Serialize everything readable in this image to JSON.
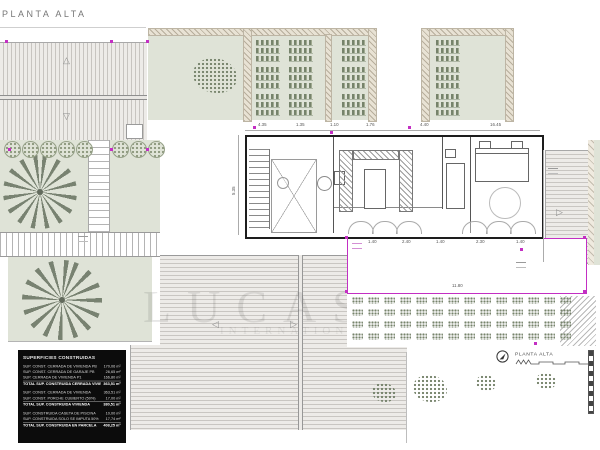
{
  "title": "PLANTA ALTA",
  "legend": {
    "label": "PLANTA ALTA"
  },
  "watermark": {
    "line1": "LUCAS F",
    "line2": "INTERNATIONAL PROPERTIES"
  },
  "colors": {
    "accent_magenta": "#c32fc3",
    "garden_green": "#dfe3d7",
    "plant_green": "#76836b",
    "wall_black": "#1d1d1d",
    "table_bg": "#0c0c0c",
    "deck_line": "#c9c6c2"
  },
  "areas_table": {
    "header": "SUPERFICIES CONSTRUIDAS",
    "groups": [
      {
        "rows": [
          {
            "label": "SUP. CONST. CERRADA DE VIVIENDA PB",
            "value": "170,06 m²",
            "total": false
          },
          {
            "label": "SUP. CONST. CERRADA DE GARAJE PB",
            "value": "26,65 m²",
            "total": false
          },
          {
            "label": "SUP. CERRADA DE VIVIENDA P1",
            "value": "166,80 m²",
            "total": false
          },
          {
            "label": "TOTAL SUP. CONSTRUIDA CERRADA VIVIENDA",
            "value": "363,51 m²",
            "total": true
          }
        ]
      },
      {
        "rows": [
          {
            "label": "SUP. CONST. CERRADA DE VIVIENDA",
            "value": "363,51 m²",
            "total": false
          },
          {
            "label": "SUP. CONST. PORCHE CUBIERTO (50%)",
            "value": "17,00 m²",
            "total": false
          },
          {
            "label": "TOTAL SUP. CONSTRUIDA VIVIENDA",
            "value": "380,51 m²",
            "total": true
          }
        ]
      },
      {
        "rows": [
          {
            "label": "SUP. CONSTRUIDA CASETA DE PISCINA",
            "value": "10,00 m²",
            "total": false
          },
          {
            "label": "SUP. CONSTRUIDA SOLO SE IMPUTA 50%",
            "value": "17,74 m²",
            "total": false
          },
          {
            "label": "TOTAL SUP. CONSTRUIDA EN PARCELA",
            "value": "408,25 m²",
            "total": true
          }
        ]
      }
    ]
  },
  "dimensions": {
    "building_top": [
      "4.35",
      "1.35",
      "1.10",
      "1.76",
      "4.40",
      "16.45"
    ],
    "pool_top": [
      "1.40",
      "2.40",
      "1.40",
      "2.30",
      "1.40"
    ],
    "pool_width": "11.80",
    "building_left": "5.35"
  }
}
